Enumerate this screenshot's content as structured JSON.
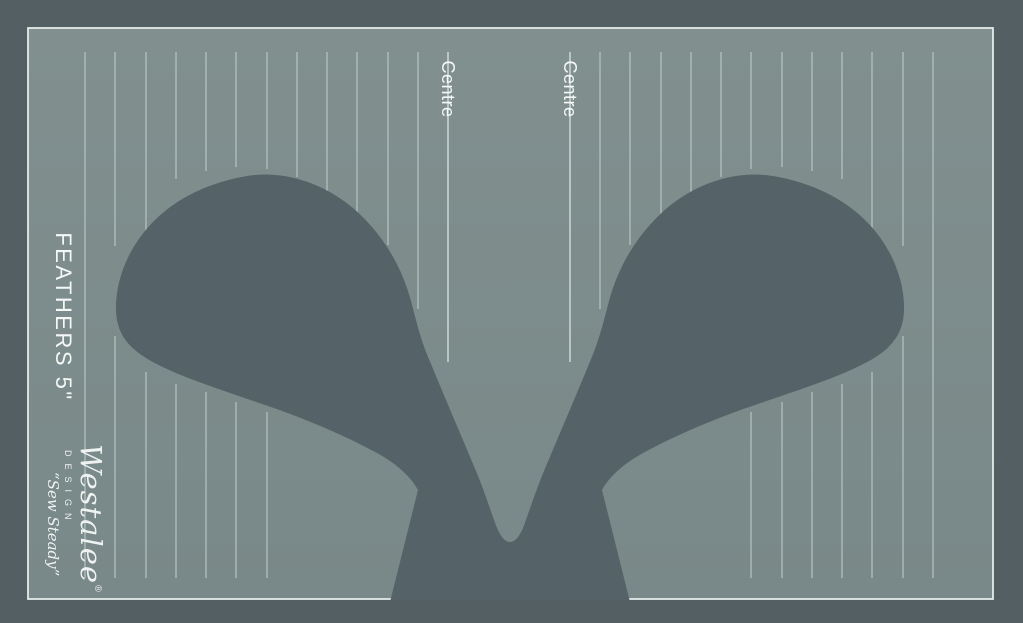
{
  "template": {
    "name_label": "FEATHERS 5\"",
    "centre_labels": [
      "Centre",
      "Centre"
    ],
    "ruler_lines": [
      {
        "x": 85,
        "segs": [
          [
            52,
            578
          ]
        ]
      },
      {
        "x": 115,
        "segs": [
          [
            52,
            246
          ],
          [
            336,
            578
          ]
        ]
      },
      {
        "x": 146,
        "segs": [
          [
            52,
            350
          ],
          [
            372,
            578
          ]
        ]
      },
      {
        "x": 176,
        "segs": [
          [
            52,
            179
          ],
          [
            384,
            578
          ]
        ]
      },
      {
        "x": 206,
        "segs": [
          [
            52,
            171
          ],
          [
            392,
            578
          ]
        ]
      },
      {
        "x": 236,
        "segs": [
          [
            52,
            167
          ],
          [
            402,
            578
          ]
        ]
      },
      {
        "x": 267,
        "segs": [
          [
            52,
            169
          ],
          [
            412,
            578
          ]
        ]
      },
      {
        "x": 297,
        "segs": [
          [
            52,
            177
          ]
        ]
      },
      {
        "x": 327,
        "segs": [
          [
            52,
            193
          ]
        ]
      },
      {
        "x": 357,
        "segs": [
          [
            52,
            216
          ]
        ]
      },
      {
        "x": 388,
        "segs": [
          [
            52,
            245
          ]
        ]
      },
      {
        "x": 418,
        "segs": [
          [
            52,
            309
          ]
        ]
      },
      {
        "x": 448,
        "segs": [
          [
            52,
            362
          ]
        ],
        "centre": true
      },
      {
        "x": 570,
        "segs": [
          [
            52,
            362
          ]
        ],
        "centre": true
      },
      {
        "x": 600,
        "segs": [
          [
            52,
            309
          ]
        ]
      },
      {
        "x": 630,
        "segs": [
          [
            52,
            245
          ]
        ]
      },
      {
        "x": 661,
        "segs": [
          [
            52,
            216
          ]
        ]
      },
      {
        "x": 691,
        "segs": [
          [
            52,
            193
          ]
        ]
      },
      {
        "x": 721,
        "segs": [
          [
            52,
            177
          ]
        ]
      },
      {
        "x": 751,
        "segs": [
          [
            52,
            169
          ],
          [
            412,
            578
          ]
        ]
      },
      {
        "x": 782,
        "segs": [
          [
            52,
            167
          ],
          [
            402,
            578
          ]
        ]
      },
      {
        "x": 812,
        "segs": [
          [
            52,
            171
          ],
          [
            392,
            578
          ]
        ]
      },
      {
        "x": 842,
        "segs": [
          [
            52,
            179
          ],
          [
            384,
            578
          ]
        ]
      },
      {
        "x": 872,
        "segs": [
          [
            52,
            350
          ],
          [
            372,
            578
          ]
        ]
      },
      {
        "x": 903,
        "segs": [
          [
            52,
            246
          ],
          [
            336,
            578
          ]
        ]
      },
      {
        "x": 933,
        "segs": [
          [
            52,
            578
          ]
        ]
      }
    ]
  },
  "logo": {
    "brand": "Westalee",
    "registered": "®",
    "design_word": "DESIGN",
    "byline": "“Sew Steady”"
  },
  "colors": {
    "outer_margin": "#545f63",
    "template_fill": "#7c8b8d",
    "template_fill_top": "#81908f",
    "feather_fill": "#556368",
    "ruler_line": "#bccac9",
    "centre_line": "#d9e3e1",
    "border_line": "#e3ebe9",
    "cut_stroke": "#cdd9d7",
    "label_text": "#f3f8f6"
  }
}
